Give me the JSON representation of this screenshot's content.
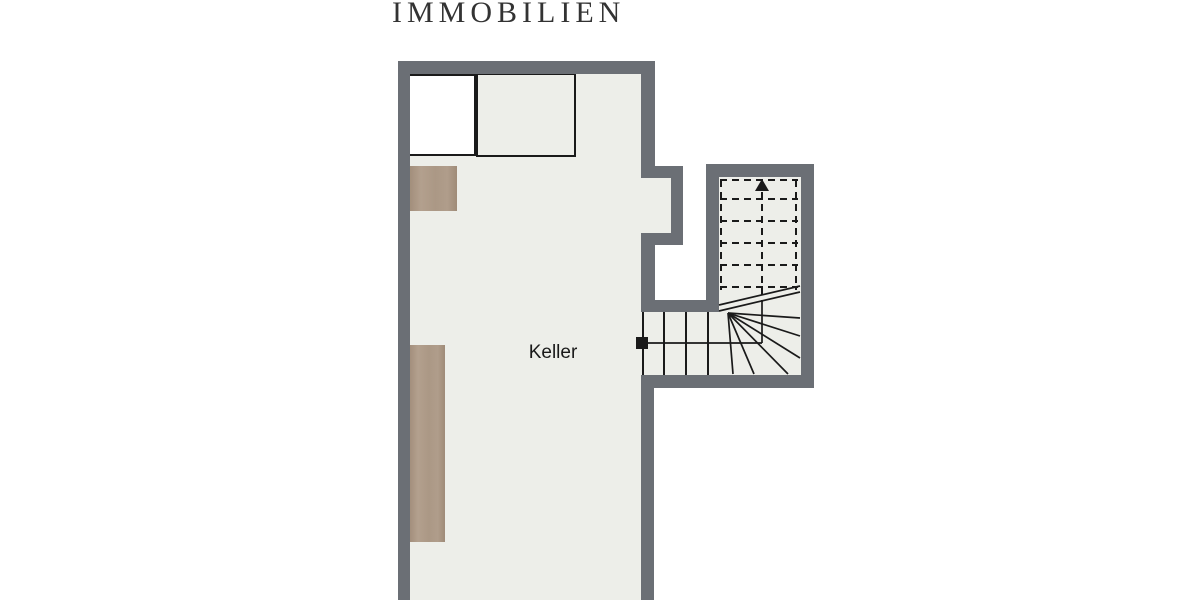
{
  "brand": {
    "logo_text": "IMMOBILIEN"
  },
  "floorplan": {
    "room_label": "Keller",
    "stairs": {
      "type": "quarter-turn winder stair",
      "direction": "up",
      "arrow_icon": "up-arrow",
      "upper_flight_style": "dashed (above section cut)",
      "lower_flight_style": "solid",
      "start_marker": "black-square"
    },
    "fixtures": [
      "white-closet-box",
      "open-storage-box",
      "wood-shelf-small",
      "wood-shelf-tall"
    ],
    "colors": {
      "wall": "#6b6f75",
      "floor": "#edeee9",
      "wood": "#ab9885",
      "line": "#1a1a1a",
      "background": "#ffffff",
      "logo_text": "#333333"
    }
  }
}
